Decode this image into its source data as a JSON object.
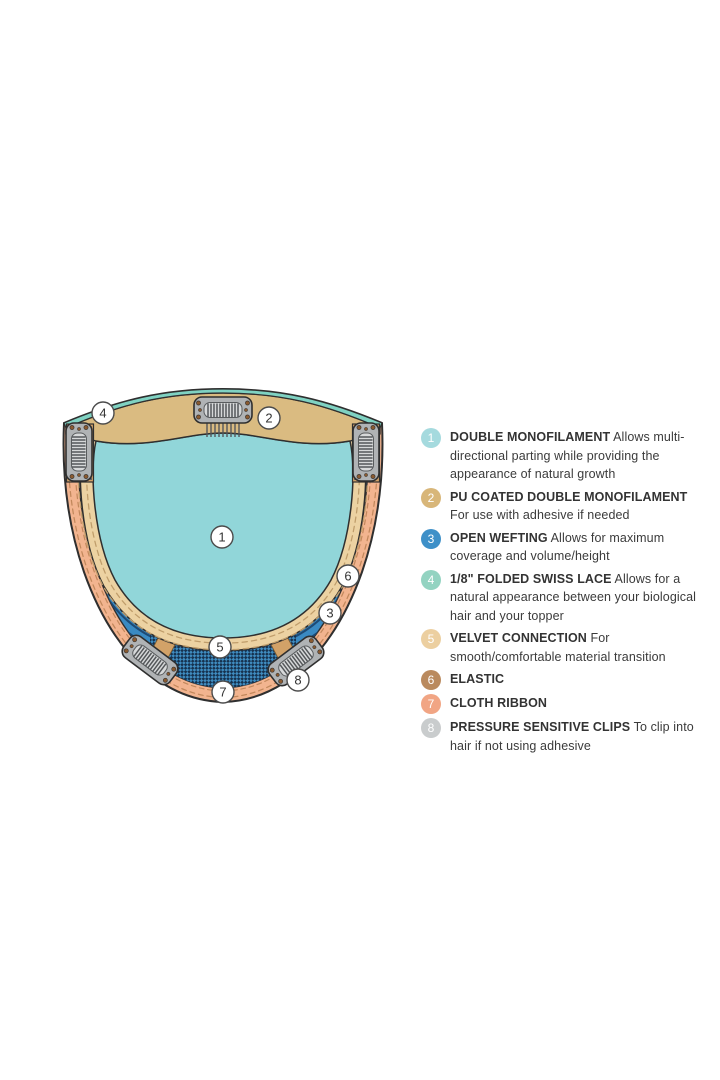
{
  "diagram": {
    "callouts": [
      {
        "number": "1"
      },
      {
        "number": "2"
      },
      {
        "number": "3"
      },
      {
        "number": "4"
      },
      {
        "number": "5"
      },
      {
        "number": "6"
      },
      {
        "number": "7"
      },
      {
        "number": "8"
      }
    ]
  },
  "colors": {
    "monofilament_aqua": "#91d6d9",
    "swiss_lace_mint": "#7fd2c2",
    "pu_band_tan": "#dabb81",
    "velvet_tan": "#ecd2a2",
    "elastic_tan": "#d2a268",
    "weft_blue": "#3a8ac2",
    "weft_dark": "#1e4a74",
    "ribbon_peach": "#f2b48f",
    "clip_gray": "#b0b3b5",
    "outline": "#2f2f2f"
  },
  "legend": {
    "items": [
      {
        "number": "1",
        "color": "#a5dade",
        "label": "DOUBLE MONOFILAMENT",
        "description": "Allows multi-directional parting while providing the appearance of natural growth"
      },
      {
        "number": "2",
        "color": "#d8b679",
        "label": "PU COATED DOUBLE MONOFILAMENT",
        "description": "For use with adhesive if needed"
      },
      {
        "number": "3",
        "color": "#3e90c8",
        "label": "OPEN WEFTING",
        "description": "Allows for maximum coverage and volume/height"
      },
      {
        "number": "4",
        "color": "#93d3c1",
        "label": "1/8\" FOLDED SWISS LACE",
        "description": "Allows for a natural appearance between your biological hair and your topper"
      },
      {
        "number": "5",
        "color": "#eccfa0",
        "label": "VELVET CONNECTION",
        "description": "For smooth/comfortable material transition"
      },
      {
        "number": "6",
        "color": "#ba8a5e",
        "label": "ELASTIC",
        "description": ""
      },
      {
        "number": "7",
        "color": "#f1a584",
        "label": "CLOTH RIBBON",
        "description": ""
      },
      {
        "number": "8",
        "color": "#c9cccd",
        "label": "PRESSURE SENSITIVE CLIPS",
        "description": "To clip into hair if not using adhesive"
      }
    ]
  }
}
